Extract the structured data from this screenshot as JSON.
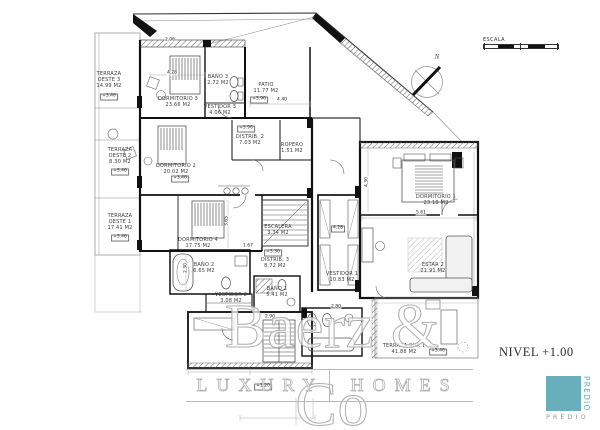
{
  "plan": {
    "labels": {
      "terraza_oeste_3": "TERRAZA\nOESTE 3\n14.99 M2",
      "terraza_oeste_2": "TERRAZA\nOESTE 2\n8.30 M2",
      "terraza_oeste_1": "TERRAZA\nOESTE 1\n17.41 M2",
      "dormitorio_3": "DORMITORIO 3\n23.66 M2",
      "bano_3": "BAÑO 3\n2.72 M2",
      "vestidor_3": "VESTIDOR 3\n4.06 M2",
      "patio": "PATIO\n11.77 M2",
      "distrib_2": "DISTRIB. 2\n7.03 M2",
      "ropero": "ROPERO\n1.51 M2",
      "dormitorio_2": "DORMITORIO 2\n20.02 M2",
      "dormitorio_4": "DORMITORIO 4\n17.75 M2",
      "bano_2": "BAÑO 2\n6.65 M2",
      "vestidor_2": "VESTIDOR 2\n3.08 M2",
      "bano_1": "BAÑO 1\n5.41 M2",
      "escalera": "ESCALERA\n3.34 M2",
      "distrib_3": "DISTRIB. 3\n8.72 M2",
      "vestidor_1": "VESTIDOR 1\n10.83 M2",
      "dormitorio_1": "DORMITORIO 1\n23.18 M2",
      "estar_2": "ESTAR 2\n21.91 M2",
      "terraza_sur_1": "TERRAZA SUR 1\n41.88 M2"
    },
    "levels": {
      "terraza_oeste_3": "+3.46",
      "terraza_oeste_2": "+3.46",
      "terraza_oeste_1": "+3.46",
      "dormitorio_2": "+3.46",
      "terraza_sur_1": "+3.46",
      "patio": "+3.96",
      "distrib_2": "+3.96",
      "distrib_3": "+3.30",
      "stair_lower": "+1.20"
    },
    "dimensions": {
      "d_206": "2.06",
      "d_428a": "4.28",
      "d_440": "4.40",
      "d_561": "5.61",
      "d_430": "4.30",
      "d_428b": "4.28",
      "d_365": "3.65",
      "d_230": "2.30",
      "d_167": "1.67",
      "d_280": "2.80",
      "d_290": "2.90"
    },
    "annotations": {
      "nivel": "NIVEL +1.00",
      "escala": "ESCALA",
      "north": "N"
    }
  },
  "watermark": {
    "brand": "Baerz & Co",
    "tag_left": "LUXURY",
    "tag_right": "HOMES"
  },
  "logo": {
    "vertical": "PREDIO",
    "caption": "PREDIO",
    "teal": "#68AEBB"
  },
  "colors": {
    "line": "#1a1a1a",
    "background": "#ffffff",
    "watermark_gray": "#adadad"
  }
}
